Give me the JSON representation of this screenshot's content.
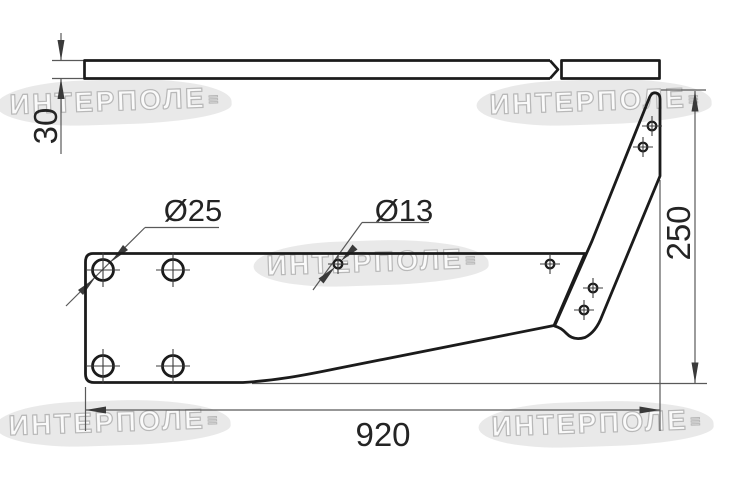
{
  "watermark": {
    "text": "ИНТЕРПОЛЕ",
    "mark": "≡"
  },
  "drawing": {
    "dim_thickness": "30",
    "dim_length": "920",
    "dim_height": "250",
    "label_hole_large": "Ø25",
    "label_hole_small": "Ø13"
  },
  "colors": {
    "outline": "#1b1b1b",
    "dimension_lines": "#595959",
    "dimension_text": "#242424",
    "watermark_text": "#ffffff",
    "watermark_blob": "#c4c4c4",
    "background": "#ffffff"
  }
}
